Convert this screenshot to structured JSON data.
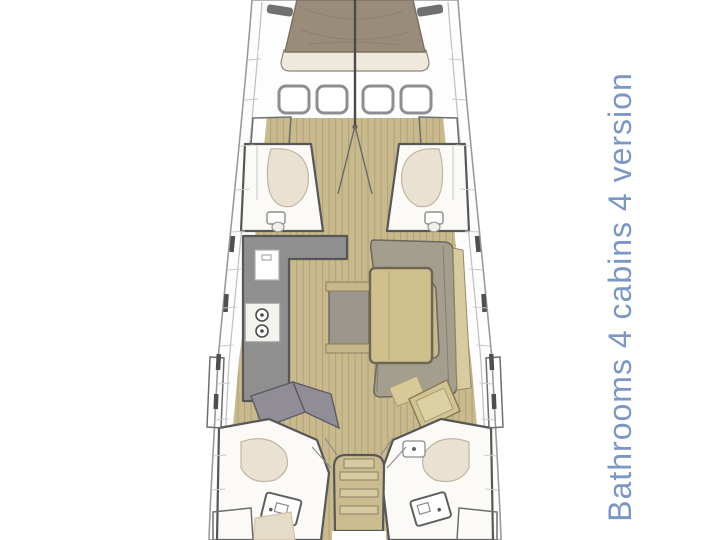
{
  "caption": {
    "text": "Bathrooms 4 cabins 4 version",
    "color": "#7b97c6",
    "rotation_deg": -90
  },
  "diagram": {
    "kind": "sailing-yacht-interior-floor-plan",
    "orientation": "bow-at-top"
  },
  "palette": {
    "background": "#ffffff",
    "deck": "#fdfdfd",
    "wood_floor": "#c9ba8e",
    "wood_plank_line": "#b3a478",
    "mattress": "#9a8c7a",
    "bed_foot": "#efe9dd",
    "hatch_fill": "#ffffff",
    "counter_gray": "#8f8f8f",
    "stove_white": "#f5f3ee",
    "sofa": "#a49e8f",
    "sofa_trim": "#d9cba0",
    "table_wood": "#cfc08c",
    "bench_gray": "#9b968b",
    "bench_cap": "#c6b88a",
    "seat_beige": "#e9e1d2",
    "berth_gray": "#908d96",
    "desk_tan": "#d2c392",
    "desk_tan_light": "#ddd1a4",
    "stair_wood": "#cbbc90",
    "stair_step": "#d8caa0",
    "bathroom_floor": "#fbfaf7",
    "grille_bg": "#e6e6e6",
    "grille_dark": "#4f4f4f",
    "pillow_beige": "#e5dcc8",
    "white": "#ffffff"
  }
}
